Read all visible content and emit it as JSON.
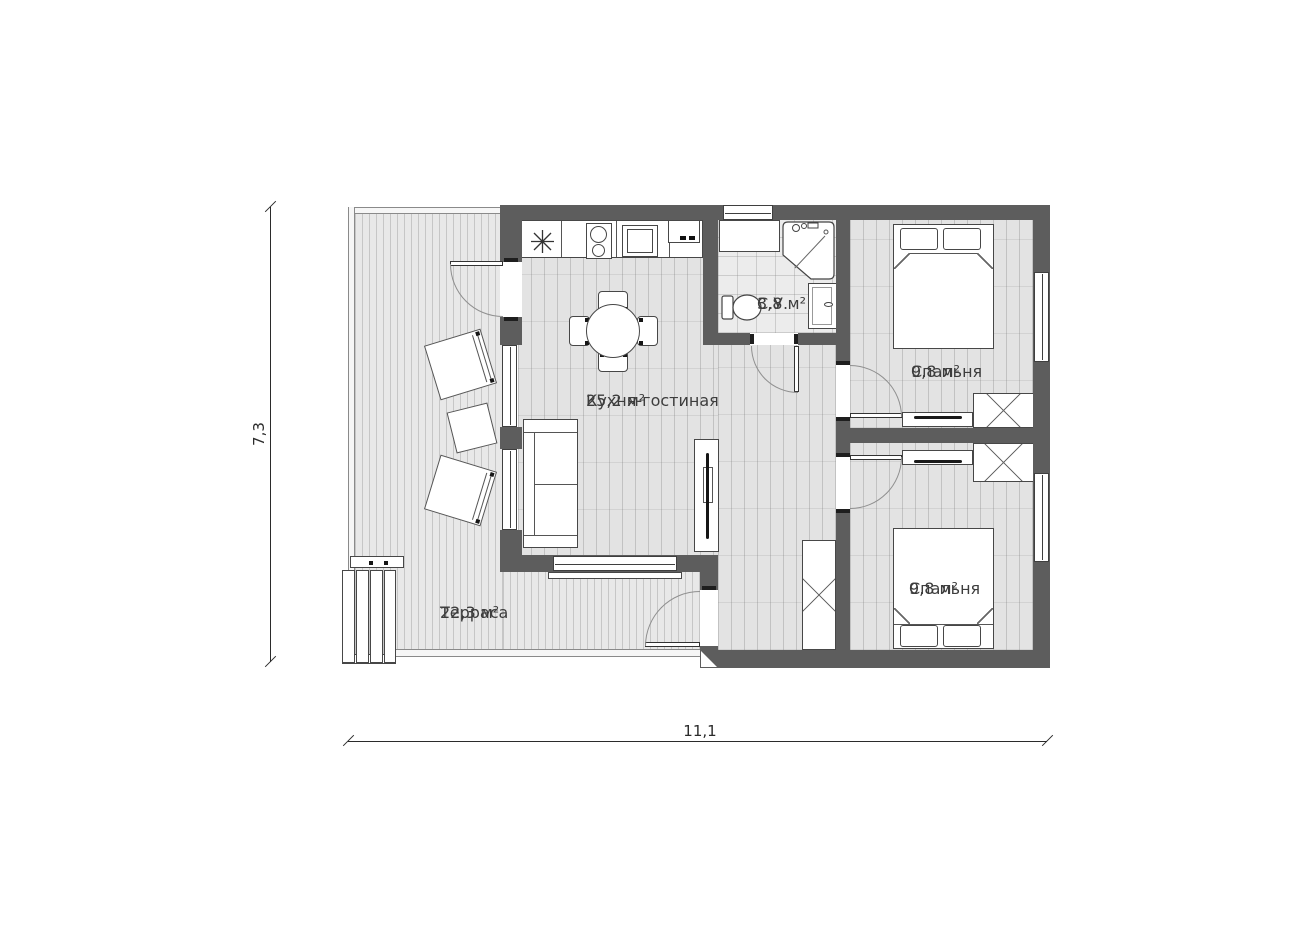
{
  "plan": {
    "title": "house-floor-plan",
    "rooms": {
      "kitchen_living": {
        "name": "Кухня-гостиная",
        "area": "25,2 м²"
      },
      "terrace": {
        "name": "Терраса",
        "area": "22,3 м²"
      },
      "bathroom": {
        "name": "С.У.",
        "area": "3,8 м²"
      },
      "bedroom1": {
        "name": "Спальня",
        "area": "9,8 м²"
      },
      "bedroom2": {
        "name": "Спальня",
        "area": "9,8 м²"
      }
    },
    "dimensions": {
      "height": "7,3",
      "width": "11,1"
    },
    "wall_color": "#5d5d5d",
    "furniture": [
      "kitchen-counter",
      "sink",
      "stove",
      "oven",
      "switch-panel",
      "dining-table",
      "dining-chairs",
      "sofa",
      "tv-cabinet",
      "shower",
      "toilet",
      "vanity",
      "bathroom-counter",
      "double-bed",
      "wardrobe",
      "tv-stand",
      "hall-wardrobe",
      "lounge-chairs",
      "terrace-table",
      "terrace-steps"
    ]
  }
}
